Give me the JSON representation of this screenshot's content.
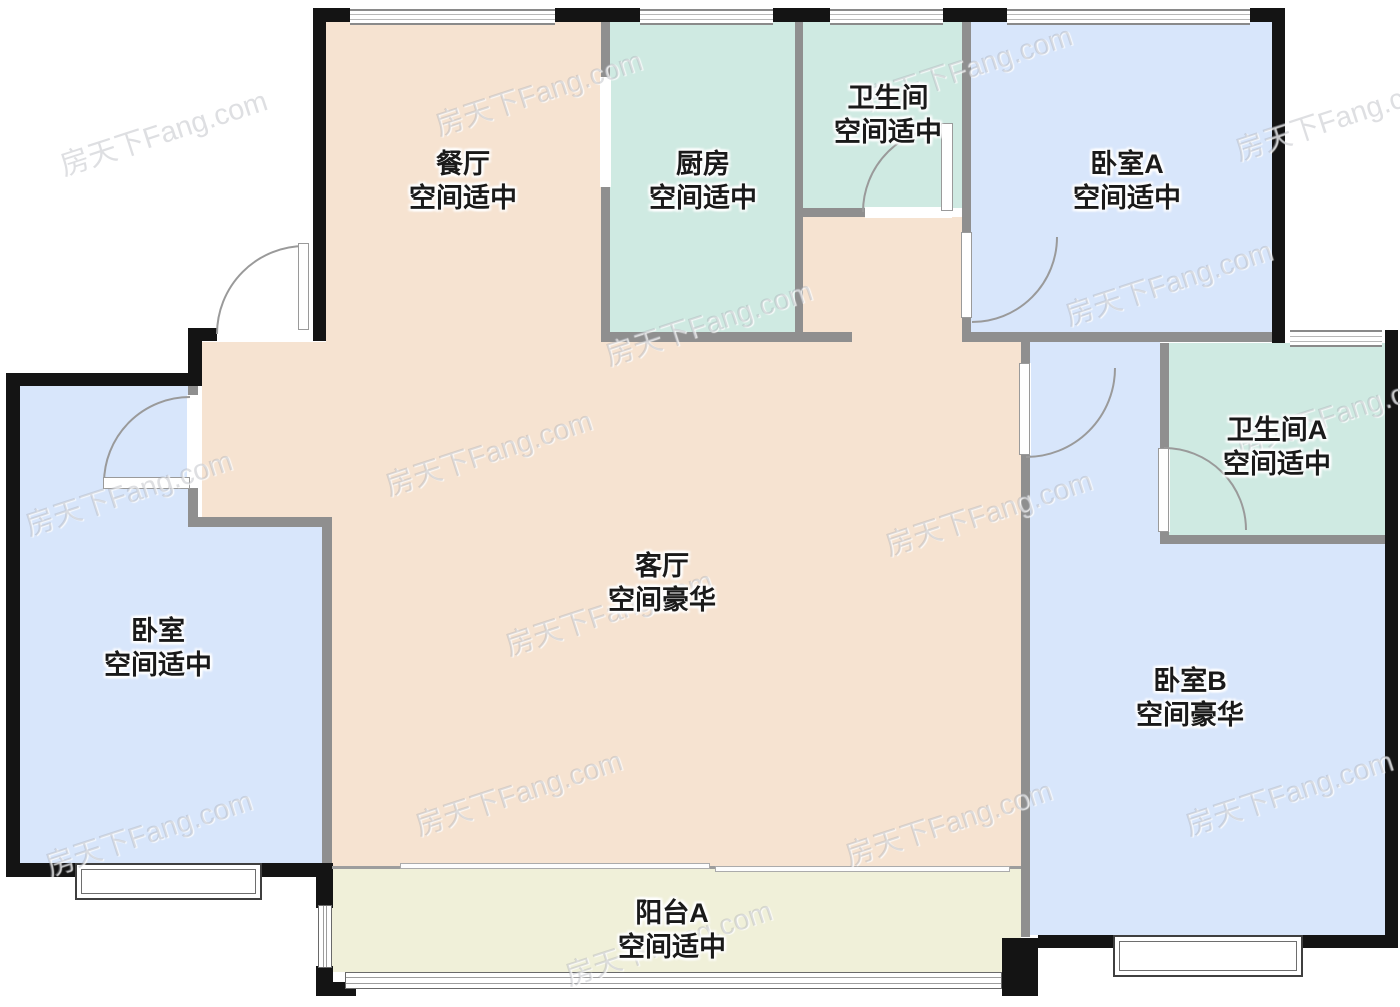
{
  "watermark": {
    "text": "房天下Fang.com"
  },
  "colors": {
    "room_warm": "#f6e3d1",
    "room_mint": "#cfeae2",
    "room_blue": "#d8e6fb",
    "room_cream": "#f0f0d9",
    "wall_exterior": "#141414",
    "wall_interior": "#8f8f8f",
    "label_text": "#1a1a1a"
  },
  "rooms": [
    {
      "name": "餐厅",
      "rating": "空间适中"
    },
    {
      "name": "厨房",
      "rating": "空间适中"
    },
    {
      "name": "卫生间",
      "rating": "空间适中"
    },
    {
      "name": "卧室A",
      "rating": "空间适中"
    },
    {
      "name": "卫生间A",
      "rating": "空间适中"
    },
    {
      "name": "客厅",
      "rating": "空间豪华"
    },
    {
      "name": "卧室",
      "rating": "空间适中"
    },
    {
      "name": "卧室B",
      "rating": "空间豪华"
    },
    {
      "name": "阳台A",
      "rating": "空间适中"
    }
  ]
}
